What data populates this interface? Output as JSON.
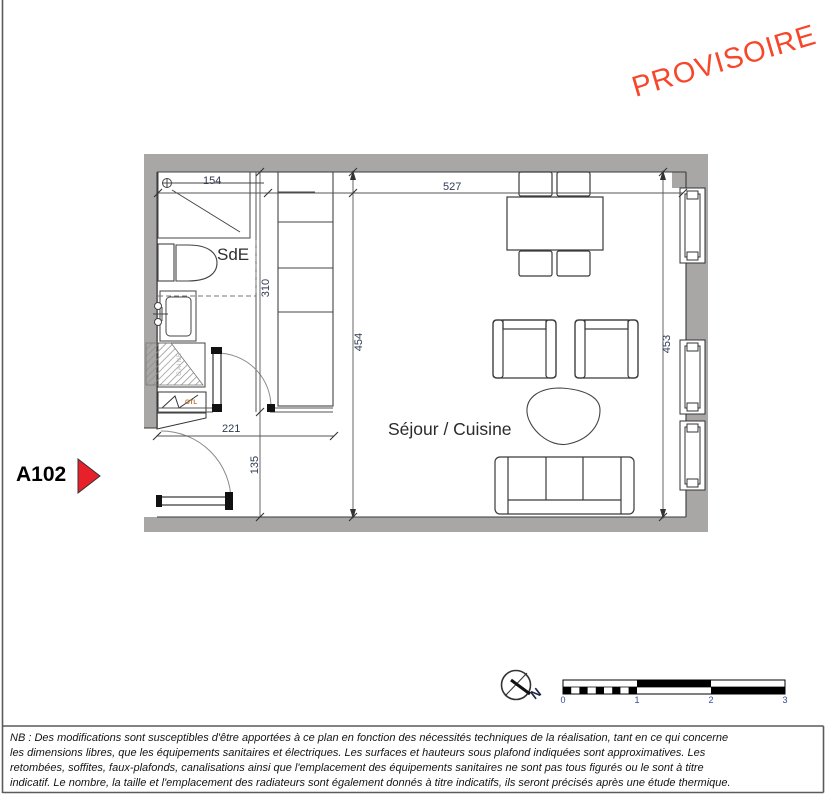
{
  "stamp": {
    "text": "PROVISOIRE",
    "color": "#f8462b"
  },
  "unit": {
    "label": "A102",
    "arrow_color": "#e8202a"
  },
  "rooms": {
    "bathroom": "SdE",
    "living": "Séjour / Cuisine"
  },
  "annotations": {
    "duct": "GAINE",
    "gtl": "GTL"
  },
  "dimensions": {
    "shower_width": "154",
    "living_width": "527",
    "bath_depth": "310",
    "entry_width": "221",
    "entry_depth": "135",
    "living_depth_left": "454",
    "living_depth_right": "453"
  },
  "compass": {
    "north": "N"
  },
  "scale_bar": {
    "ticks": [
      "0",
      "1",
      "2",
      "3"
    ]
  },
  "colors": {
    "wall": "#a9a6a6",
    "dim_text": "#2f3a52",
    "scale_numbers": "#3a4a9c"
  },
  "note": {
    "lines": [
      "NB : Des modifications sont susceptibles d'être apportées à ce plan en fonction des nécessités techniques de la réalisation,  tant en ce qui concerne",
      "les dimensions libres, que les équipements sanitaires et électriques. Les surfaces et hauteurs sous plafond indiquées sont approximatives. Les",
      "retombées, soffites, faux-plafonds, canalisations ainsi que l'emplacement des équipements sanitaires ne sont pas tous figurés ou le sont à titre",
      "indicatif. Le nombre, la taille et l'emplacement des radiateurs sont également donnés à titre indicatifs, ils seront précisés après une étude thermique."
    ]
  }
}
